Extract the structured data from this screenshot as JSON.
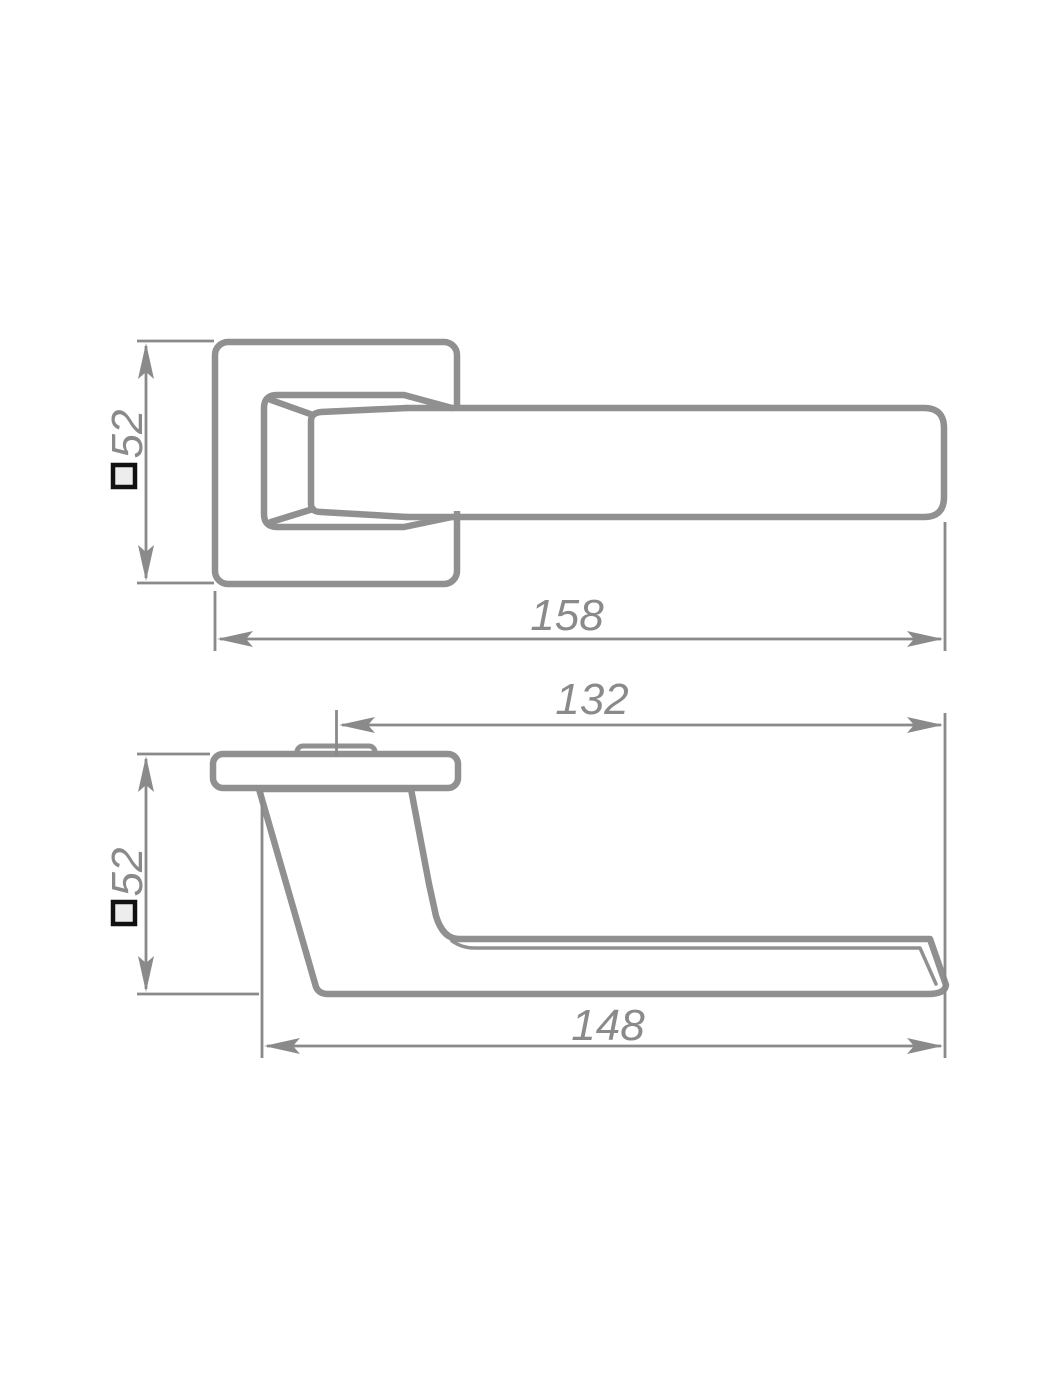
{
  "page": {
    "type": "technical-drawing",
    "subject": "Door lever handle on square rosette - two orthographic projection views with dimensions",
    "background": "#ffffff"
  },
  "colors": {
    "object_line": "#909090",
    "dimension_line": "#8a8a8a",
    "dimension_text": "#8a8a8a",
    "square_symbol_stroke": "#111111",
    "square_symbol_fill": "#ededed"
  },
  "front_view": {
    "dim_rose_size": {
      "symbol": "□",
      "value": "52",
      "orientation": "vertical"
    },
    "dim_overall_length": {
      "value": "158",
      "orientation": "horizontal"
    }
  },
  "side_view": {
    "dim_projection_length": {
      "value": "132",
      "orientation": "horizontal"
    },
    "dim_rose_size": {
      "symbol": "□",
      "value": "52",
      "orientation": "vertical"
    },
    "dim_grip_length": {
      "value": "148",
      "orientation": "horizontal"
    }
  }
}
